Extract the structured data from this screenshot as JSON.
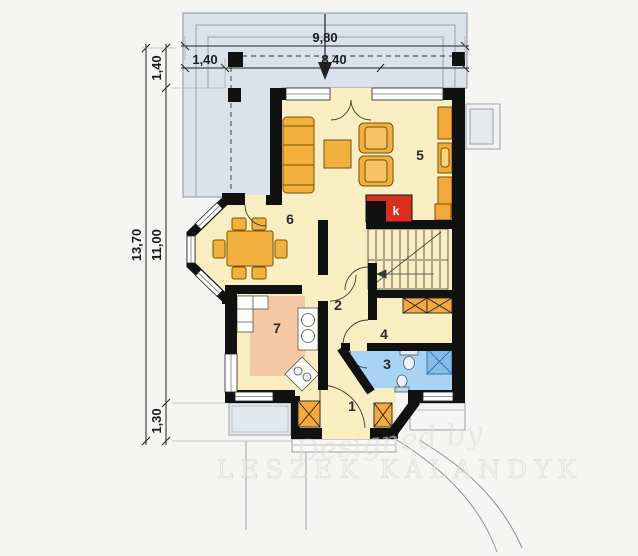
{
  "plan": {
    "kind": "house ground-floor plan"
  },
  "dimensions": {
    "top": {
      "total": "9,80",
      "main": "8,40",
      "offset": "1,40"
    },
    "left": {
      "total": "13,70",
      "main": "11,00",
      "top_offset": "1,40",
      "bottom_offset": "1,30"
    }
  },
  "rooms": [
    {
      "label": "1"
    },
    {
      "label": "2"
    },
    {
      "label": "3"
    },
    {
      "label": "4"
    },
    {
      "label": "5"
    },
    {
      "label": "6"
    },
    {
      "label": "7"
    }
  ],
  "fireplace": {
    "label": "k"
  },
  "watermark": {
    "line1": "Designed by",
    "line2": "LESZEK KALANDYK"
  },
  "colors": {
    "walls": "#111111",
    "floor_cream": "#f8eec1",
    "kitchen_floor": "#f4c7a6",
    "bathroom_floor": "#a9d3f2",
    "terrace": "#dbe2ea",
    "furniture_orange": "#f2b13e",
    "fireplace_red": "#d9301d",
    "shower_blue": "#86bce8"
  }
}
